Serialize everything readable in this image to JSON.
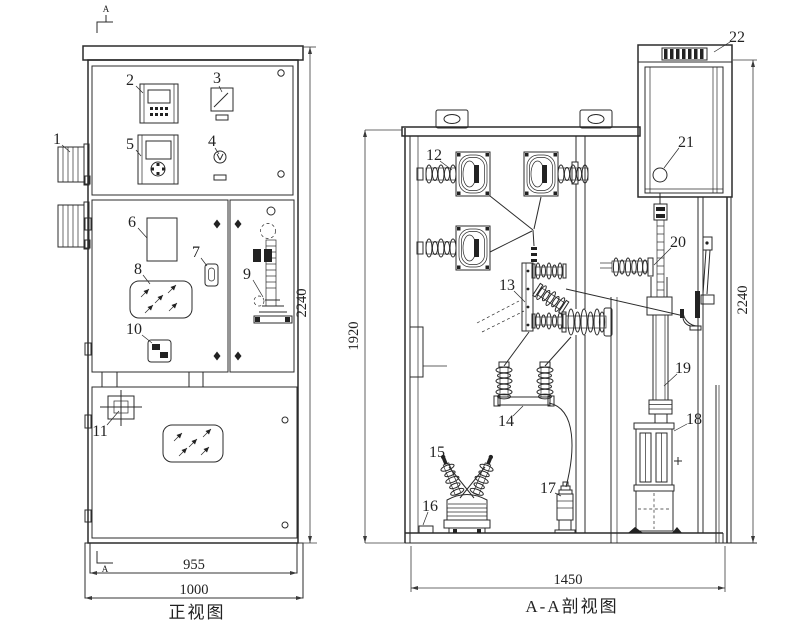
{
  "front_view": {
    "title": "正视图",
    "section_marker": "A",
    "dimensions": {
      "inner_width": "955",
      "outer_width": "1000",
      "height": "2240"
    },
    "callouts": {
      "c1": "1",
      "c2": "2",
      "c3": "3",
      "c4": "4",
      "c5": "5",
      "c6": "6",
      "c7": "7",
      "c8": "8",
      "c9": "9",
      "c10": "10",
      "c11": "11"
    }
  },
  "section_view": {
    "title": "A-A剖视图",
    "dimensions": {
      "depth": "1450",
      "inner_height": "1920",
      "height": "2240"
    },
    "callouts": {
      "c12": "12",
      "c13": "13",
      "c14": "14",
      "c15": "15",
      "c16": "16",
      "c17": "17",
      "c18": "18",
      "c19": "19",
      "c20": "20",
      "c21": "21",
      "c22": "22"
    }
  }
}
